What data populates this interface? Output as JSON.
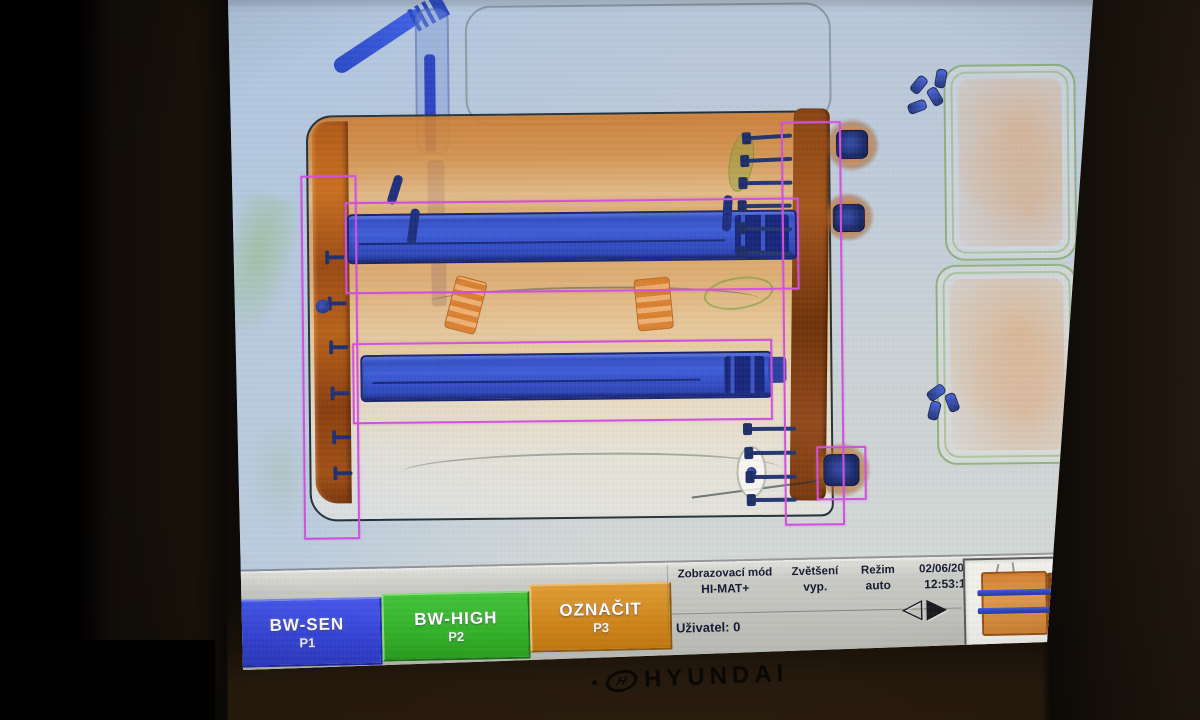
{
  "monitor": {
    "brand": "HYUNDAI"
  },
  "toolbar": {
    "buttons": [
      {
        "label": "BW-SEN",
        "key": "P1",
        "color": "#3a49e0"
      },
      {
        "label": "BW-HIGH",
        "key": "P2",
        "color": "#31b42a"
      },
      {
        "label": "OZNAČIT",
        "key": "P3",
        "color": "#d4871e"
      }
    ],
    "status": {
      "display_mode_label": "Zobrazovací mód",
      "display_mode_value": "HI-MAT+",
      "zoom_label": "Zvětšení",
      "zoom_value": "vyp.",
      "mode_label": "Režim",
      "mode_value": "auto",
      "date": "02/06/2015",
      "time": "12:53:14",
      "user": "Uživatel: 0"
    },
    "nav": {
      "prev_icon": "◁",
      "next_icon": "▶"
    }
  },
  "scan": {
    "annotation_color": "#d24fe0",
    "detection_count": 5
  }
}
